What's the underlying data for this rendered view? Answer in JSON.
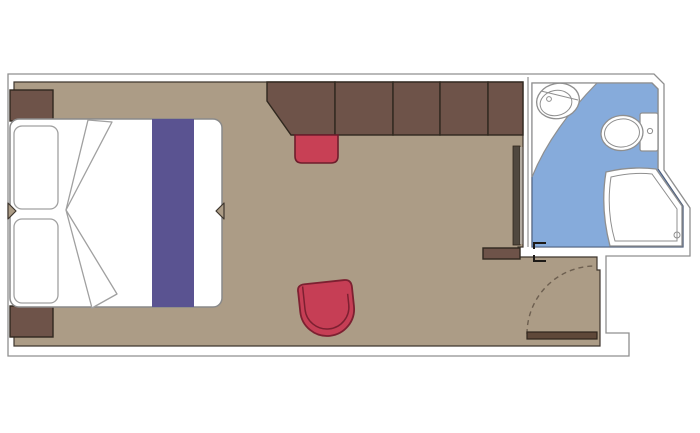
{
  "page": {
    "title": "Cabin floor plan",
    "background": "#ffffff"
  },
  "colors": {
    "wall_fill": "#ffffff",
    "wall_line": "#8f8f8f",
    "floor": "#ac9c86",
    "floor_edge": "#3e362e",
    "wood": "#6e5349",
    "wood_dark": "#30281f",
    "red": "#c63e55",
    "red_dark": "#7d2031",
    "red_stool": "#c84055",
    "red_stool_dark": "#6e1d2c",
    "purple": "#5a5391",
    "blue": "#86abdb",
    "blue_edge": "#4a5c7d",
    "fixture_fill": "#ffffff",
    "bed_line": "#8a8a8a",
    "pillow_line": "#a0a0a0",
    "door_wood": "#5f4839",
    "door_wood_dark": "#2f251c",
    "swing": "#6d5f50",
    "gray_door": "#50483f",
    "gray_door_edge": "#b3aba1",
    "bracket": "#1d1a17"
  },
  "parts": {
    "room": "cabin-floor",
    "bathroom": "bathroom-floor",
    "bed": "double-bed",
    "runner": "bed-runner",
    "wardrobe": "wardrobe-units",
    "desk": "desk-unit",
    "stool": "stool",
    "armchair": "armchair",
    "sink": "sink",
    "toilet": "toilet",
    "shower": "shower",
    "entrance": "entrance-door",
    "bathroom_door": "bathroom-door"
  }
}
